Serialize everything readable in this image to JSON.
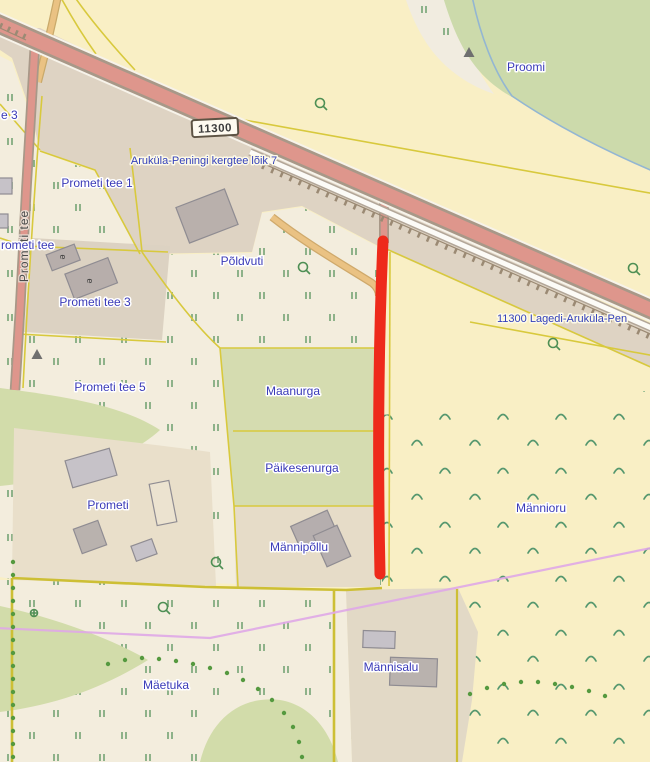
{
  "map": {
    "labels": {
      "proomi": "Proomi",
      "prometi_tee_vertical": "Prometi tee",
      "prometi_tee_partial": "rometi tee",
      "tee_3_partial": "e 3",
      "prometi_tee_1": "Prometi tee 1",
      "prometi_tee_3": "Prometi tee 3",
      "prometi_tee_5": "Prometi tee 5",
      "poldvuti": "Põldvuti",
      "maanurga": "Maanurga",
      "paikesenurga": "Päikesenurga",
      "prometi": "Prometi",
      "mannipollu": "Männipõllu",
      "mannioru": "Männioru",
      "mannisalu": "Männisalu",
      "maetuka": "Mäetuka"
    },
    "roads": {
      "shield_ref": "11300",
      "kergtee_label": "Aruküla-Peningi kergtee lõik 7",
      "lagedi_label": "11300 Lagedi-Aruküla-Pen"
    },
    "building_marks": {
      "mark1": "e",
      "mark2": "e"
    },
    "palette": {
      "farmland": "#f9efc5",
      "meadow": "#f3eddd",
      "grass": "#d2dcaa",
      "forest": "#ccdaab",
      "yard": "#e9dfca",
      "road_strip": "#ded3c3",
      "road_fill": "#de968c",
      "road_casing": "#a89888",
      "track": "#eac283",
      "cadastral_line": "#d8c93d",
      "highlight": "#ee2a1b",
      "powerline": "#dfa7e7",
      "water_line": "#93b6d2",
      "building_fill": "#c6c2c8",
      "label_blue": "#3a3ab8"
    }
  }
}
